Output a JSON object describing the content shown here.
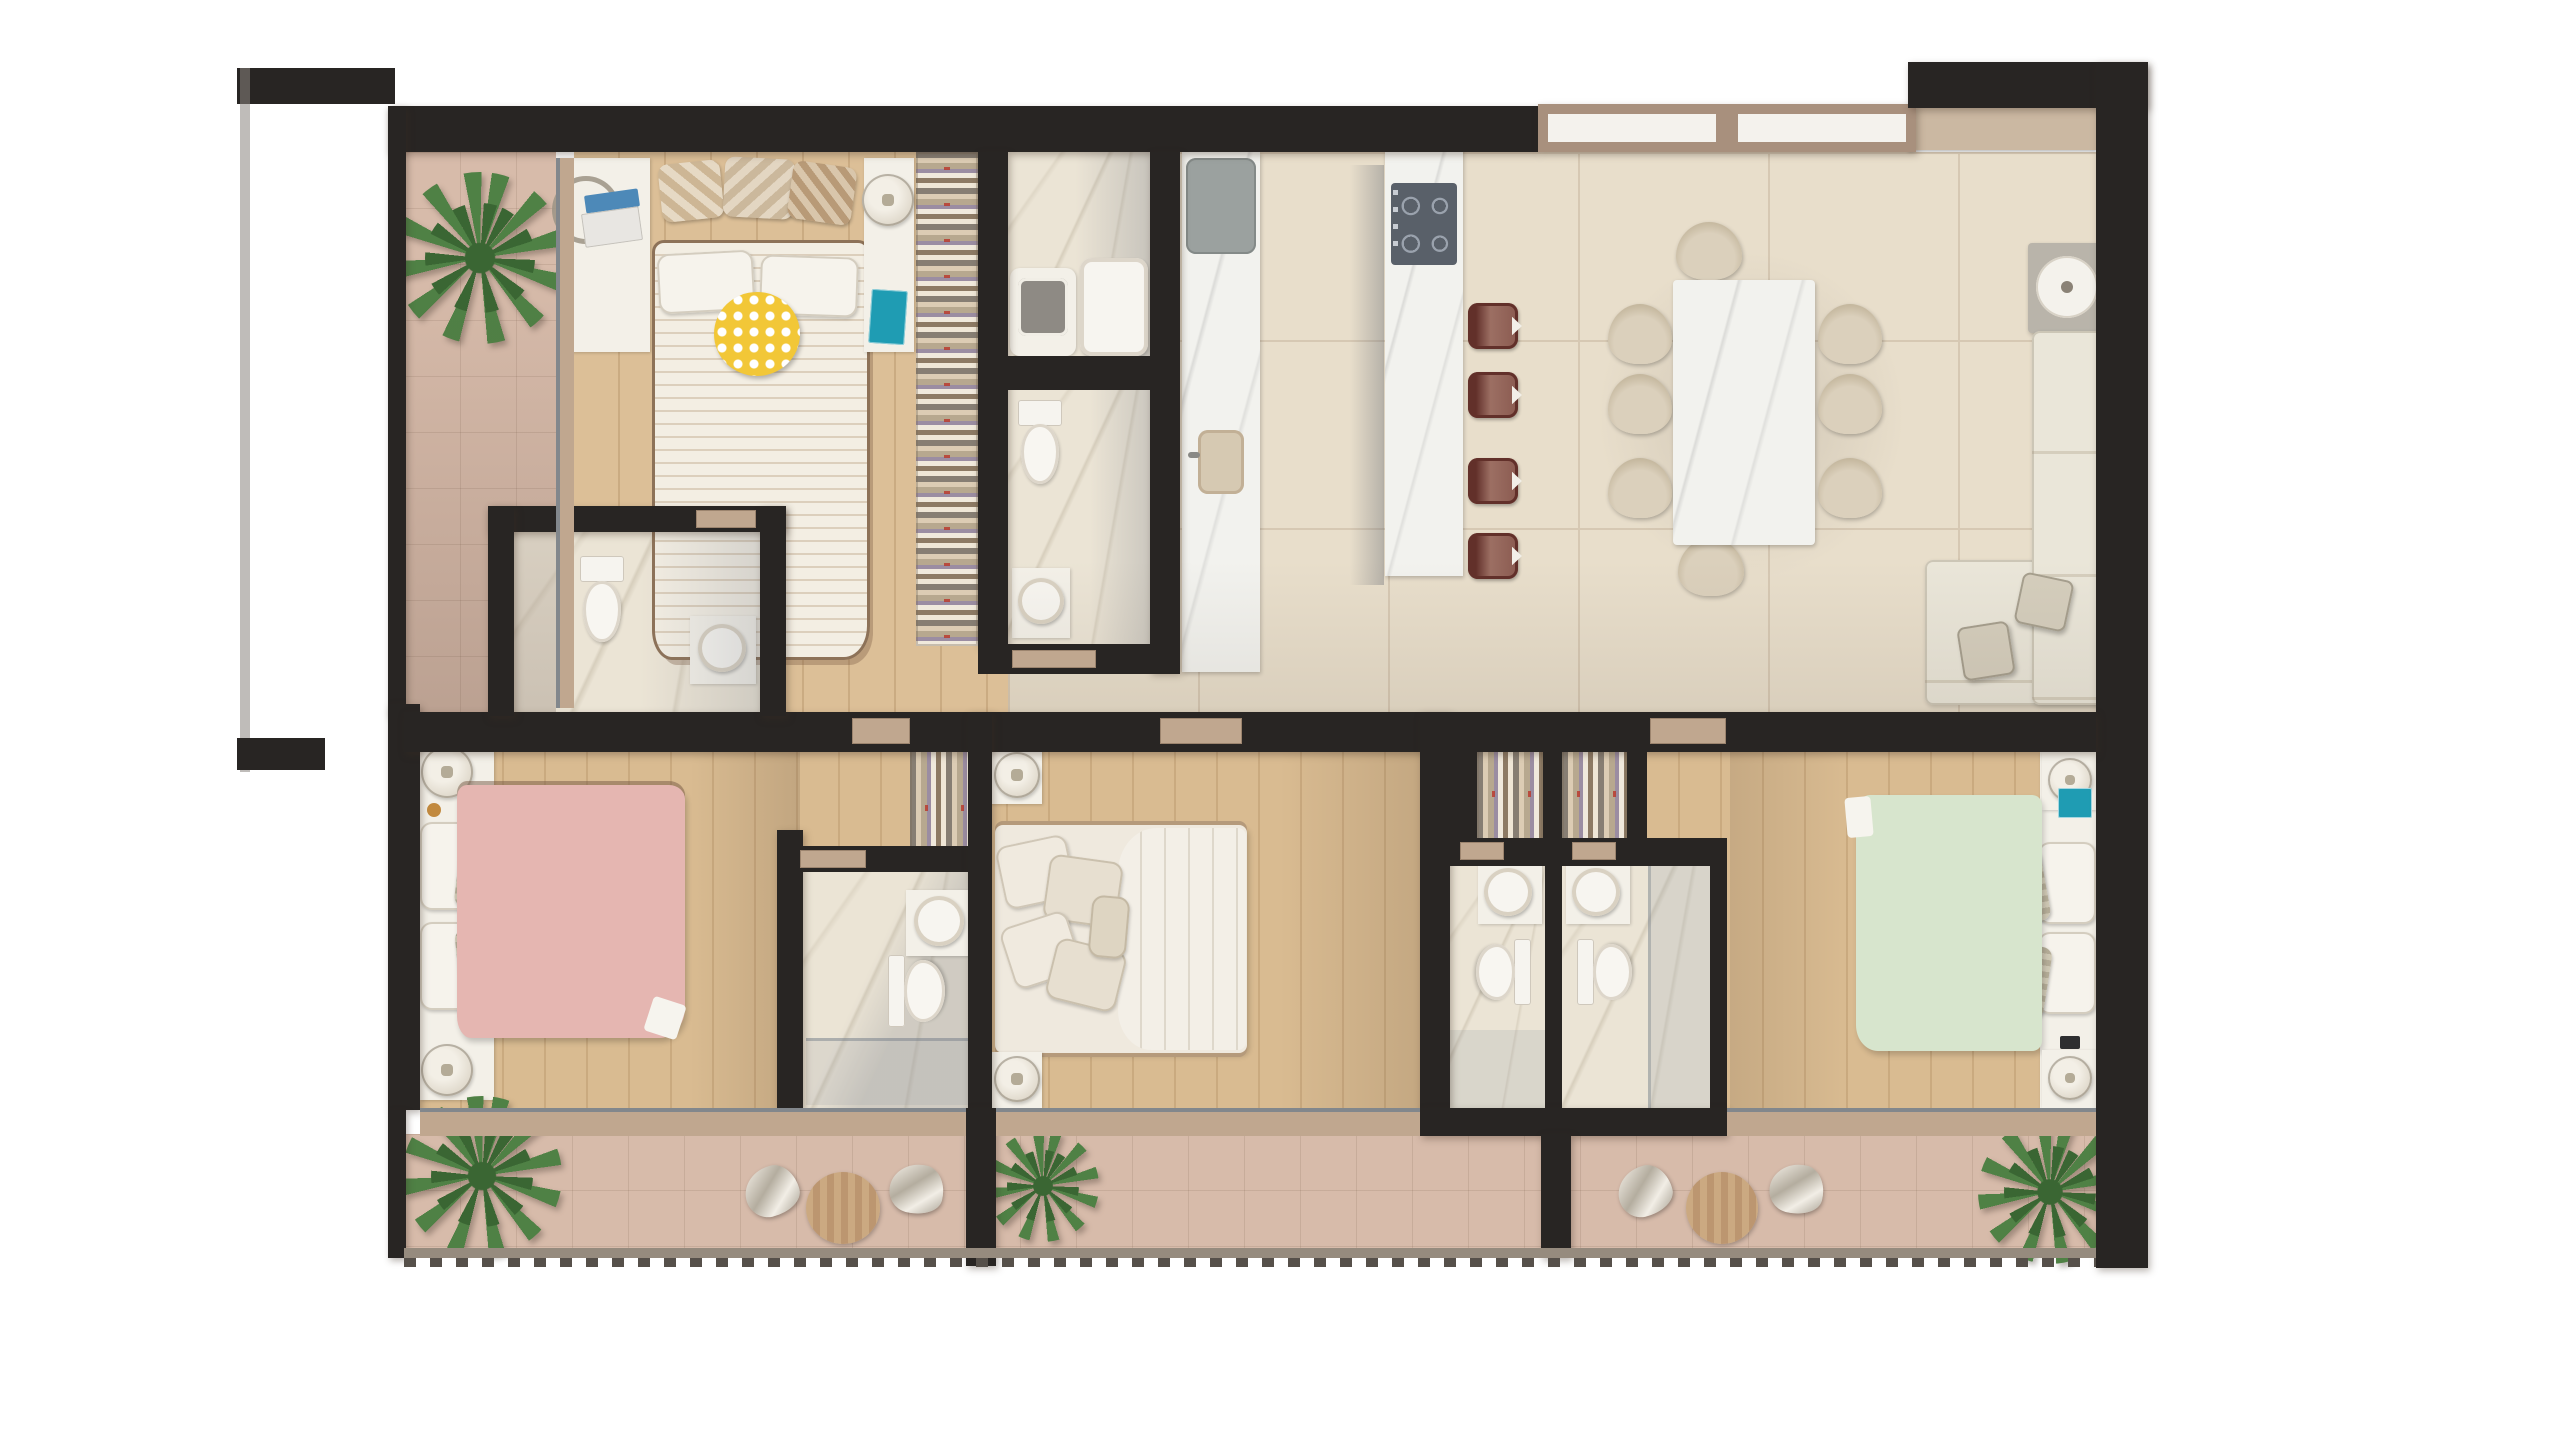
{
  "scene": {
    "type": "apartment floor plan, top-down 3D render, no text labels",
    "rooms": [
      "left-balcony",
      "master-bedroom",
      "master-bathroom",
      "wc",
      "powder-room",
      "kitchen",
      "dining-area",
      "living-room",
      "pink-bedroom",
      "pink-bathroom",
      "middle-bedroom",
      "bathroom-left",
      "bathroom-right",
      "green-bedroom",
      "bottom-terrace"
    ],
    "counts": {
      "beds": 4,
      "bar_stools": 4,
      "dining_chairs": 8,
      "terrace_chair_sets": 2,
      "plants": 4,
      "toilets": 5,
      "sinks": 6,
      "bathtubs": 1,
      "sofas": 1,
      "closet_racks": 5
    }
  },
  "colors": {
    "wall": "#282523",
    "wallSoft": "#4e4843",
    "tile": "#e8decb",
    "tileLine": "#d6c8b3",
    "wood": "#dcbf97",
    "woodBottom": "#d9bb91",
    "stone": "#d7bbaa",
    "marble": "#ebe4d5",
    "marbleWhite": "#f2f2ee",
    "surface": "#f3f0e8",
    "closet": "#efe6d6",
    "doorTan": "#c0a78f",
    "glassFrame": "#a8907d",
    "windowPane": "#f4f2ed",
    "ledge": "#cbb8a2",
    "pink": "#e5b6b1",
    "green": "#d7e5cd",
    "cream": "#efe9df",
    "maroon": "#7c3b33",
    "maroonDark": "#62302a",
    "yellow": "#f2c737",
    "teal": "#1f9cb3",
    "sofa": "#eae6d9",
    "sofaLine": "#d5cebd",
    "chair": "#dbd0bc",
    "chairShade": "#c6b9a0",
    "plant": "#4f8145",
    "plantDark": "#3a6633",
    "fridge": "#9ba19f",
    "cooktop": "#596069",
    "mirror": "#8e8a84"
  }
}
